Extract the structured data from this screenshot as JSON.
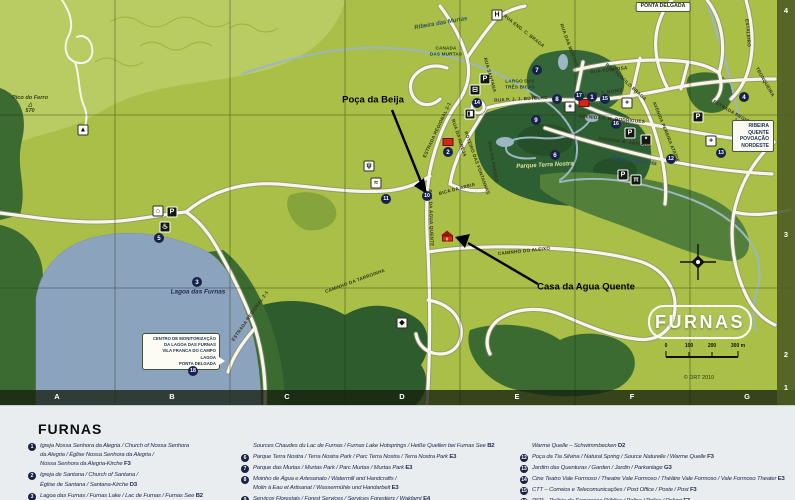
{
  "map": {
    "title": "FURNAS",
    "copyright": "© DRT 2010",
    "colors": {
      "land": "#a9bf47",
      "forest": "#3c6b31",
      "park": "#2e5f33",
      "lake": "#8ca3be",
      "road": "#f8f5ea",
      "stream": "#9cb6c3",
      "marker": "#17224a",
      "red_building": "#d22618"
    },
    "grid": {
      "cols": [
        {
          "t": "A",
          "x": 57
        },
        {
          "t": "B",
          "x": 172
        },
        {
          "t": "C",
          "x": 287
        },
        {
          "t": "D",
          "x": 402
        },
        {
          "t": "E",
          "x": 517
        },
        {
          "t": "F",
          "x": 632
        },
        {
          "t": "G",
          "x": 747
        }
      ],
      "rows": [
        {
          "t": "4",
          "y": 6
        },
        {
          "t": "3",
          "y": 230
        },
        {
          "t": "2",
          "y": 350
        },
        {
          "t": "1",
          "y": 383
        }
      ]
    },
    "scale_labels": [
      {
        "t": "0",
        "x": 666
      },
      {
        "t": "100",
        "x": 689
      },
      {
        "t": "200",
        "x": 712
      },
      {
        "t": "300 m",
        "x": 738
      }
    ],
    "monitor_lines": [
      "CENTRO DE MONITORIZAÇÃO",
      "DA LAGOA DAS FURNAS",
      "VILA FRANCA DO CAMPO",
      "LAGOA",
      "PONTA DELGADA"
    ],
    "labels": [
      {
        "name": "stream-label-ribeira-das-murtas",
        "t": "Ribeira das Murtas",
        "x": 441,
        "y": 24,
        "rot": -10,
        "cls": "stream"
      },
      {
        "name": "road-label-canada-das-murtas",
        "t": "CANADA\nDAS MURTAS",
        "x": 446,
        "y": 51,
        "rot": 0,
        "cls": "tinyl"
      },
      {
        "name": "place-label-largo-das-tres-bicas",
        "t": "LARGO DAS\nTRÊS BICAS",
        "x": 520,
        "y": 84,
        "rot": 0,
        "cls": "tinyl"
      },
      {
        "name": "road-label-rua-p-j-j-botelho",
        "t": "RUA P. J. J. BOTELHO",
        "x": 521,
        "y": 99,
        "rot": -3,
        "cls": "road"
      },
      {
        "name": "road-label-rua-formosa",
        "t": "RUA FORMOSA",
        "x": 609,
        "y": 70,
        "rot": -7,
        "cls": "road"
      },
      {
        "name": "road-label-rua-teofilo-braga",
        "t": "RUA TEÓFILO BRAGA",
        "x": 626,
        "y": 82,
        "rot": 42,
        "cls": "road"
      },
      {
        "name": "road-label-rua-eng-c-braga",
        "t": "RUA ENG. C. BRAGA",
        "x": 524,
        "y": 31,
        "rot": 38,
        "cls": "road"
      },
      {
        "name": "road-label-rua-dr-f-moniz",
        "t": "RUA DR. F. MONIZ",
        "x": 601,
        "y": 93,
        "rot": -8,
        "cls": "road"
      },
      {
        "name": "road-label-avenida-f-m-rodrigues",
        "t": "AVENIDA F. M. RODRIGUES",
        "x": 612,
        "y": 119,
        "rot": 5,
        "cls": "road"
      },
      {
        "name": "road-label-avenida-m-arriaga",
        "t": "AVENIDA M. ARRIAGA",
        "x": 625,
        "y": 142,
        "rot": 8,
        "cls": "road"
      },
      {
        "name": "road-label-avenida-pereira-ataide",
        "t": "AVENIDA PEREIRA ATAÍDE",
        "x": 666,
        "y": 132,
        "rot": 68,
        "cls": "road"
      },
      {
        "name": "stream-label-ribeira-amarela",
        "t": "Ribeira Amarela",
        "x": 634,
        "y": 162,
        "rot": 7,
        "cls": "stream"
      },
      {
        "name": "road-label-estrada-regional-north",
        "t": "ESTRADA REGIONAL 2-1",
        "x": 437,
        "y": 130,
        "rot": -65,
        "cls": "road"
      },
      {
        "name": "road-label-rua-da-igreja",
        "t": "RUA DA IGREJA",
        "x": 459,
        "y": 138,
        "rot": 72,
        "cls": "road"
      },
      {
        "name": "road-label-rua-da-agua-quente",
        "t": "RUA DA ÁGUA QUENTE",
        "x": 431,
        "y": 218,
        "rot": 88,
        "cls": "road"
      },
      {
        "name": "road-label-roteiro-das-fontanhas",
        "t": "ROTEIRO DAS FONTANHAS",
        "x": 477,
        "y": 163,
        "rot": 70,
        "cls": "road"
      },
      {
        "name": "road-label-rua-do-paredo",
        "t": "RUA DO PAREDO",
        "x": 493,
        "y": 162,
        "rot": 80,
        "cls": "road"
      },
      {
        "name": "road-label-bica-da-areia",
        "t": "BICA DA AREIA",
        "x": 457,
        "y": 189,
        "rot": -15,
        "cls": "road"
      },
      {
        "name": "road-label-caminho-do-aleixo",
        "t": "CAMINHO DO ALEIXO",
        "x": 524,
        "y": 251,
        "rot": -6,
        "cls": "road"
      },
      {
        "name": "road-label-caminho-da-tarroinha",
        "t": "CAMINHO DA TARROINHA",
        "x": 355,
        "y": 281,
        "rot": -20,
        "cls": "road"
      },
      {
        "name": "road-label-estrada-regional-lake",
        "t": "ESTRADA REGIONAL 2-1",
        "x": 250,
        "y": 316,
        "rot": -55,
        "cls": "road"
      },
      {
        "name": "road-label-estrada-regional-east",
        "t": "ESTRADA REGIONAL 2-1",
        "x": 737,
        "y": 118,
        "rot": 30,
        "cls": "road"
      },
      {
        "name": "road-label-estaleiro",
        "t": "ESTALEIRO",
        "x": 748,
        "y": 33,
        "rot": 85,
        "cls": "road"
      },
      {
        "name": "road-label-tronqueira",
        "t": "TRONQUEIRA",
        "x": 765,
        "y": 82,
        "rot": 60,
        "cls": "road"
      },
      {
        "name": "road-label-rua-das-murtas",
        "t": "RUA DAS MURTAS",
        "x": 569,
        "y": 45,
        "rot": 70,
        "cls": "road"
      },
      {
        "name": "road-label-rua-santana",
        "t": "RUA SANTANA",
        "x": 490,
        "y": 75,
        "rot": 74,
        "cls": "road"
      },
      {
        "name": "peak-label-pico-do-ferro",
        "t": "Pico do Ferro\n△\n570",
        "x": 30,
        "y": 105,
        "rot": 0,
        "cls": "peak"
      },
      {
        "name": "lake-label-lagoa-das-furnas",
        "t": "Lagoa das Furnas",
        "x": 198,
        "y": 292,
        "rot": 0,
        "cls": "place"
      },
      {
        "name": "park-label-parque-terra-nostra",
        "t": "Parque Terra Nostra",
        "x": 545,
        "y": 166,
        "rot": -3,
        "cls": "park"
      },
      {
        "name": "callout-label-poca-da-beija",
        "t": "Poça da Beija",
        "x": 373,
        "y": 101,
        "rot": 0,
        "cls": "callout"
      },
      {
        "name": "callout-label-casa-da-agua-quente",
        "t": "Casa da Agua Quente",
        "x": 586,
        "y": 288,
        "rot": 0,
        "cls": "callout"
      },
      {
        "name": "sign-ponta-delgada",
        "t": "PONTA DELGADA",
        "x": 663,
        "y": 7,
        "rot": 0,
        "cls": "signbox"
      },
      {
        "name": "sign-ribeira-quente-povoacao-nordeste",
        "t": "RIBEIRA QUENTE\nPOVOAÇÃO\nNORDESTE",
        "x": 753,
        "y": 136,
        "rot": 0,
        "cls": "signbox2"
      },
      {
        "name": "scale-label",
        "t": "0",
        "x": 666,
        "y": 347,
        "rot": 0,
        "cls": "scale"
      },
      {
        "name": "scale-label",
        "t": "100",
        "x": 689,
        "y": 347,
        "rot": 0,
        "cls": "scale"
      },
      {
        "name": "scale-label",
        "t": "200",
        "x": 712,
        "y": 347,
        "rot": 0,
        "cls": "scale"
      },
      {
        "name": "scale-label",
        "t": "300 m",
        "x": 738,
        "y": 347,
        "rot": 0,
        "cls": "scale"
      },
      {
        "name": "map-copyright",
        "t": "© DRT 2010",
        "x": 699,
        "y": 378,
        "rot": 0,
        "cls": "copy"
      }
    ],
    "markers": [
      {
        "n": "1",
        "x": 592,
        "y": 97
      },
      {
        "n": "15",
        "x": 605,
        "y": 99
      },
      {
        "n": "17",
        "x": 579,
        "y": 96
      },
      {
        "n": "16",
        "x": 616,
        "y": 124
      },
      {
        "n": "12",
        "x": 671,
        "y": 159
      },
      {
        "n": "13",
        "x": 721,
        "y": 153
      },
      {
        "n": "4",
        "x": 744,
        "y": 97
      },
      {
        "n": "14",
        "x": 477,
        "y": 103
      },
      {
        "n": "2",
        "x": 448,
        "y": 152
      },
      {
        "n": "7",
        "x": 537,
        "y": 70
      },
      {
        "n": "8",
        "x": 557,
        "y": 99
      },
      {
        "n": "9",
        "x": 536,
        "y": 120
      },
      {
        "n": "6",
        "x": 555,
        "y": 155
      },
      {
        "n": "3",
        "x": 197,
        "y": 282
      },
      {
        "n": "5",
        "x": 159,
        "y": 238
      },
      {
        "n": "10",
        "x": 427,
        "y": 196
      },
      {
        "n": "11",
        "x": 386,
        "y": 199
      },
      {
        "n": "18",
        "x": 193,
        "y": 371
      }
    ],
    "icons": [
      {
        "g": "hospital",
        "cls": "light",
        "x": 497,
        "y": 15
      },
      {
        "g": "parking",
        "cls": "dark",
        "x": 485,
        "y": 79
      },
      {
        "g": "bus",
        "cls": "dark",
        "x": 475,
        "y": 90
      },
      {
        "g": "fuel",
        "cls": "dark",
        "x": 470,
        "y": 114
      },
      {
        "g": "parking",
        "cls": "dark",
        "x": 630,
        "y": 133
      },
      {
        "g": "parking",
        "cls": "dark",
        "x": 623,
        "y": 175
      },
      {
        "g": "picnic",
        "cls": "dark",
        "x": 636,
        "y": 180
      },
      {
        "g": "parking",
        "cls": "dark",
        "x": 698,
        "y": 117
      },
      {
        "g": "parking",
        "cls": "dark",
        "x": 172,
        "y": 212
      },
      {
        "g": "monument",
        "cls": "light",
        "x": 158,
        "y": 211
      },
      {
        "g": "hotspring",
        "cls": "dark",
        "x": 165,
        "y": 227
      },
      {
        "g": "church",
        "cls": "light",
        "x": 570,
        "y": 107
      },
      {
        "g": "maltese-cross",
        "cls": "light",
        "x": 627,
        "y": 103
      },
      {
        "g": "fountain",
        "cls": "light",
        "x": 369,
        "y": 166
      },
      {
        "g": "swim",
        "cls": "light",
        "x": 376,
        "y": 183
      },
      {
        "g": "viewpoint",
        "cls": "light",
        "x": 402,
        "y": 323
      },
      {
        "g": "church",
        "cls": "light",
        "x": 711,
        "y": 141
      },
      {
        "g": "watermill",
        "cls": "dark",
        "x": 646,
        "y": 140
      },
      {
        "g": "trail",
        "cls": "light",
        "x": 83,
        "y": 130
      },
      {
        "g": "red-building",
        "cls": "red",
        "x": 584,
        "y": 103
      },
      {
        "g": "red-building",
        "cls": "red",
        "x": 448,
        "y": 142
      },
      {
        "g": "house",
        "cls": "house",
        "x": 447,
        "y": 236
      }
    ]
  },
  "legend": {
    "title": "FURNAS",
    "columns": [
      {
        "x": 40,
        "w": 205,
        "items": [
          {
            "num": "1",
            "lines": [
              "Igreja Nossa Senhora da Alegria / Church of Nossa Senhora",
              "da Alegria / Église Nossa Senhora da Alegria /",
              "Nossa Senhora da Alegria-Kirche F3"
            ]
          },
          {
            "num": "2",
            "lines": [
              "Igreja de Santana / Church of Santana /",
              "Église de Santana / Santana-Kirche D3"
            ]
          },
          {
            "num": "3",
            "lines": [
              "Lagoa das Furnas / Furnas Lake / Lac de Furnas / Furnas See B2"
            ]
          }
        ]
      },
      {
        "x": 253,
        "w": 272,
        "items": [
          {
            "num": "",
            "lines": [
              "Sources Chaudes du Lac de Furnas / Furnas Lake Hotsprings / Heiße Quellen bei Furnas See B2"
            ]
          },
          {
            "num": "6",
            "lines": [
              "Parque Terra Nostra / Terra Nostra Park / Parc Terra Nostra / Terra Nostra Park E3"
            ]
          },
          {
            "num": "7",
            "lines": [
              "Parque das Murtas / Murtas Park / Parc Murtas / Murtas Park E3"
            ]
          },
          {
            "num": "8",
            "lines": [
              "Moinho de Água e Artesanato / Watermill and Handcrafts /",
              "Molin à Eau et Artisanat / Wassermühle und Handarbeit E3"
            ]
          },
          {
            "num": "9",
            "lines": [
              "Serviços Florestais / Forest Services / Services Forestiers / Waldamt E4"
            ]
          }
        ]
      },
      {
        "x": 532,
        "w": 258,
        "items": [
          {
            "num": "",
            "lines": [
              "Warme Quelle – Schwimmbecken D2"
            ]
          },
          {
            "num": "12",
            "lines": [
              "Poça da Tia Silvina / Natural Spring / Source Naturelle / Warme Quelle F3"
            ]
          },
          {
            "num": "13",
            "lines": [
              "Jardim das Quenturas / Garden / Jardin / Parkanlage G3"
            ]
          },
          {
            "num": "14",
            "lines": [
              "Cine Teatro Vale Formoso / Theatre Vale Formoso / Théâtre Vale Formoso / Vale Formoso Theater E3"
            ]
          },
          {
            "num": "15",
            "lines": [
              "CTT – Correios e Telecomunicações / Post Office / Poste / Post F3"
            ]
          },
          {
            "num": "16",
            "lines": [
              "PSP – Polícia de Segurança Pública / Police / Police / Polizei F3"
            ]
          }
        ]
      }
    ]
  }
}
